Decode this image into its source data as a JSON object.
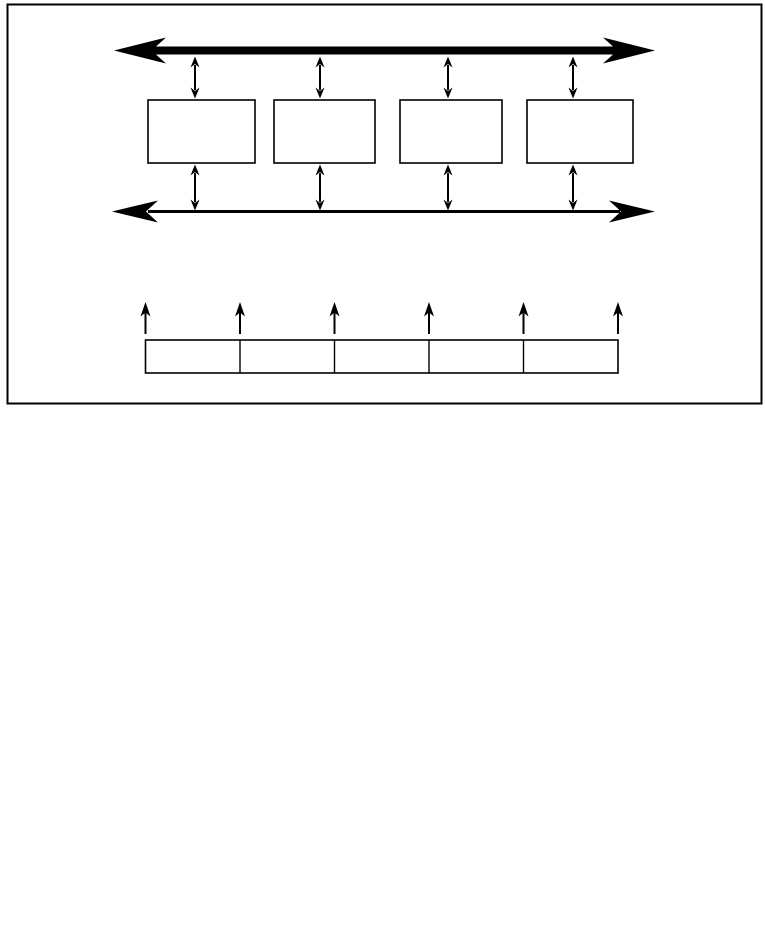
{
  "colors": {
    "ink": "#000000",
    "background": "#ffffff"
  },
  "figure": {
    "kind": "black-and-white line diagram inside a rectangular border, no text labels",
    "top_section": {
      "thick_bus": "thick horizontal double-headed arrow",
      "thin_bus": "thin horizontal double-headed arrow",
      "device_box_count": 4,
      "device_box_label": "",
      "vertical_link_count": 8,
      "vertical_link_shape": "small vertical double-headed arrow"
    },
    "bottom_section": {
      "array_cell_count": 5,
      "array_cell_label": "",
      "up_arrow_count": 6,
      "up_arrow_shape": "upward pointing arrow at each cell boundary"
    }
  }
}
